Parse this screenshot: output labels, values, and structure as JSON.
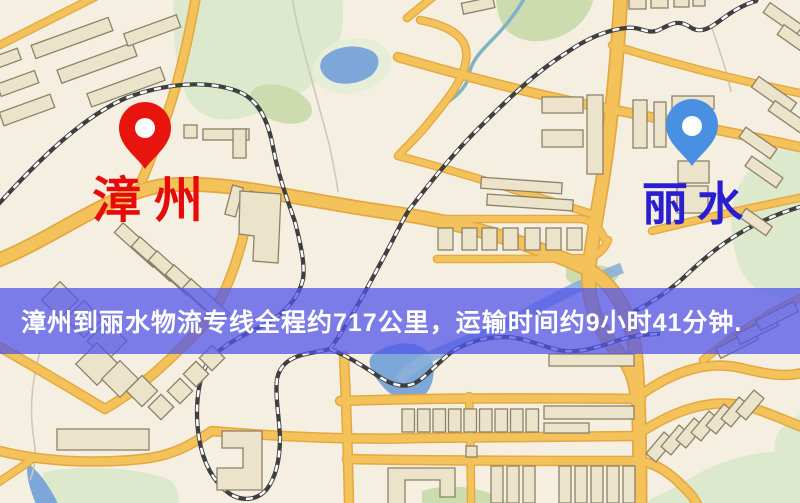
{
  "page": {
    "width": 800,
    "height": 503
  },
  "banner": {
    "text": "漳州到丽水物流专线全程约717公里，运输时间约9小时41分钟.",
    "background": "rgba(82,86,234,0.75)",
    "text_color": "#ffffff"
  },
  "map": {
    "origin": {
      "label": "漳州",
      "pin_color": "#e8140e",
      "label_color": "#e80a08"
    },
    "destination": {
      "label": "丽水",
      "pin_color": "#4a90e2",
      "label_color": "#2a1ed2"
    }
  },
  "map_palette": {
    "background": "#f5efe2",
    "road": "#f4c25a",
    "road_casing": "#e5a83e",
    "railway": "#3f3f3f",
    "building_fill": "#ece3cb",
    "building_stroke": "#8d8268",
    "park": "#dce9cc",
    "water": "#7da7d8"
  }
}
